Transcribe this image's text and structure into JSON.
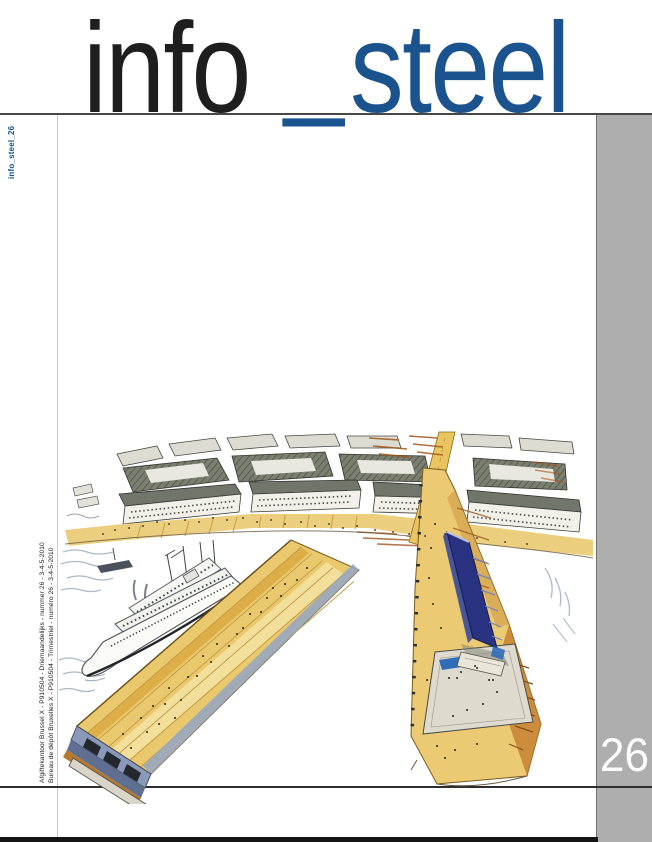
{
  "masthead": {
    "part1": "info",
    "separator": "_",
    "part2": "steel"
  },
  "spine_label": "info_steel_26",
  "mailing": {
    "line_nl": "Afgiftekantoor Brussel X - P910504 - Driemaandelijks - nummer 26 - 3-4-5-2010",
    "line_fr": "Bureau de dépôt Bruxelles X - P910504 - Trimestriel - numéro 26 - 3-4-5-2010"
  },
  "issue_number": "26",
  "colors": {
    "accent_blue": "#1b538f",
    "title_black": "#1e1e1e",
    "sidebar_gray": "#aeaeae",
    "quay_ochre": "#eac96e",
    "slab_navy": "#293381"
  },
  "illustration": {
    "description": "Aerial colour-pencil sketch of a harbour masterplan: rows of city blocks along a quay, a long diagonal pier with a docked ferry, and a second pier carrying a dark blue slab building beside a pale esplanade."
  }
}
